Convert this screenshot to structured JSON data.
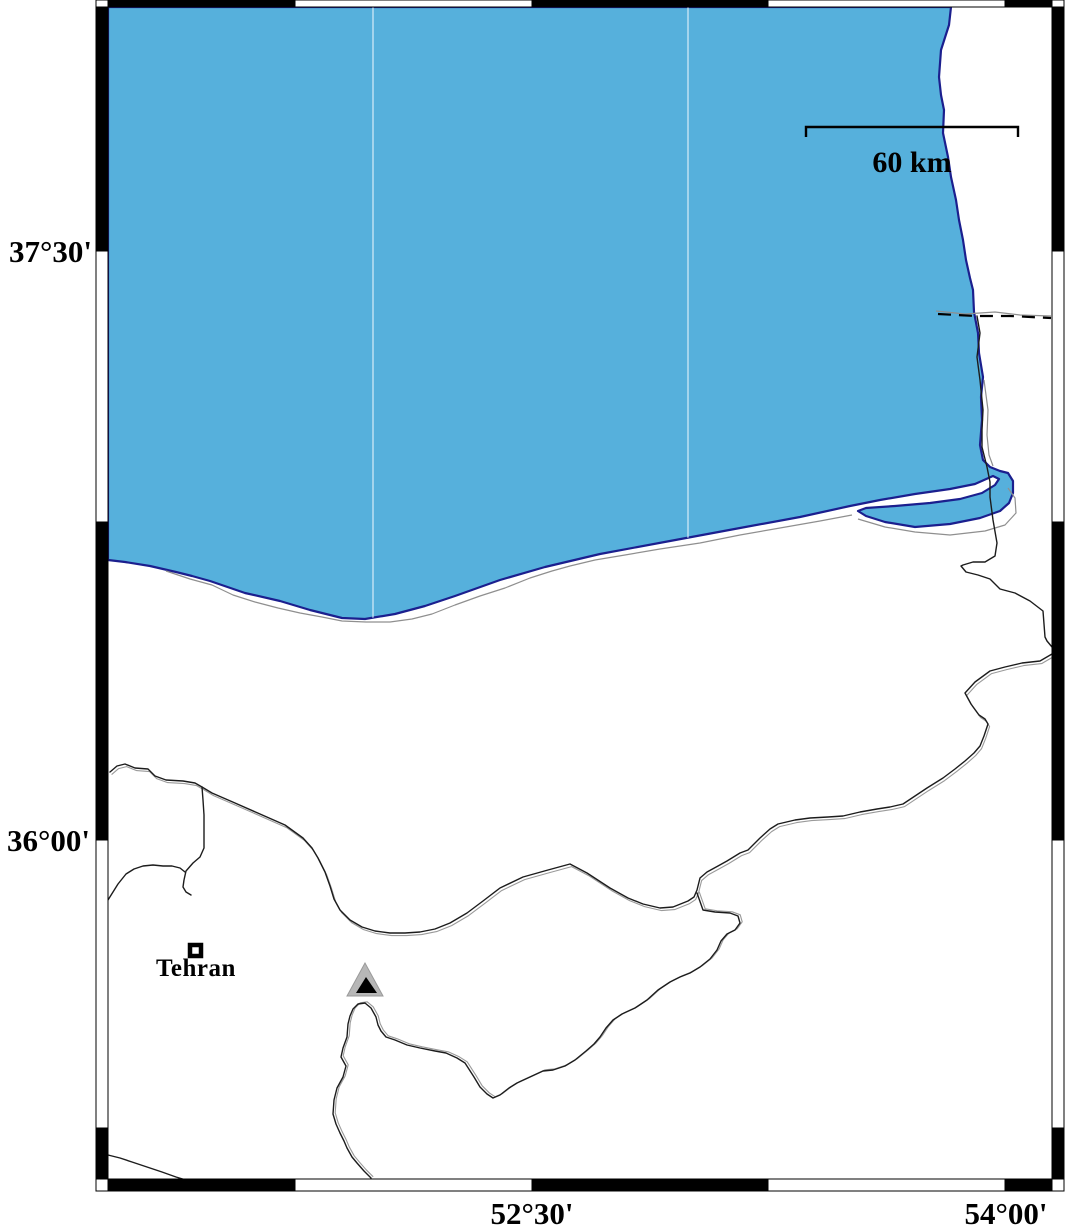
{
  "page": {
    "title": "South Caspian Sea coastal map"
  },
  "frame": {
    "left_labels": [
      "37°30'",
      "36°00'"
    ],
    "bottom_labels": [
      "52°30'",
      "54°00'"
    ]
  },
  "scale_bar": {
    "label": "60 km"
  },
  "markers": {
    "city_label": "Tehran",
    "volcano": "summit-triangle"
  },
  "colors": {
    "water": "#56b0dc",
    "coast": "#1b1f8e",
    "land": "#ffffff",
    "boundary": "#1c1c1c",
    "boundary-shadow": "#9a9a9a",
    "gray-line": "#8f8f8f",
    "gridline": "#d9eef8",
    "volcano-gray": "#b7b7b7",
    "frame-black": "#000000",
    "text": "#000000"
  }
}
